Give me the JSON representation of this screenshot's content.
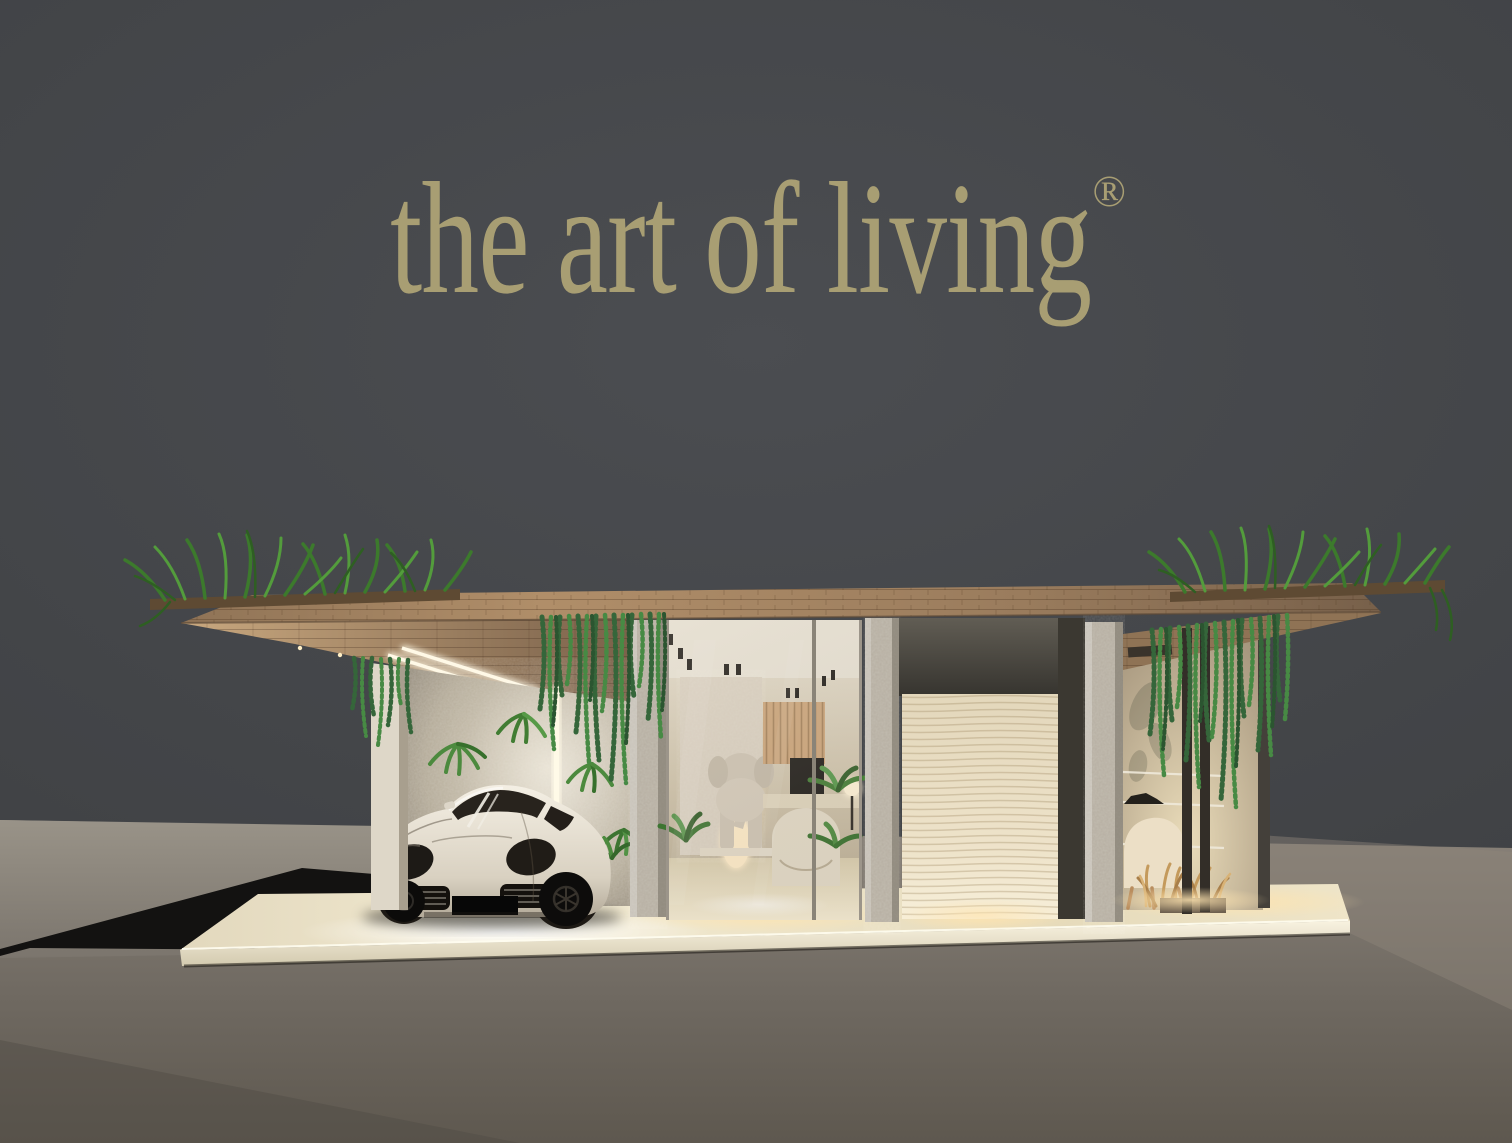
{
  "logo": {
    "text": "the art of living",
    "registered_mark": "®",
    "color": "#a89e73"
  },
  "palette": {
    "background_wall": "#46484b",
    "exhibition_floor": "#6f6961",
    "side_pavement": "#8f8a82",
    "entry_ramp": "#131211",
    "platform": "#e8dec3",
    "wood": "#9a7c5d",
    "stone": "#b5aea1",
    "foliage": "#418031",
    "led_light": "#fff6dd",
    "brand": "#a89e73"
  },
  "scene": {
    "elements": [
      "roof-canopy-with-grass-garden",
      "hanging-vines",
      "carport-with-white-sports-car",
      "led-light-strips",
      "glass-showroom-with-elephant-sculpture",
      "textured-display-panel",
      "stone-columns",
      "lounge-corner-with-shelves",
      "display-platform",
      "entry-ramp"
    ]
  }
}
